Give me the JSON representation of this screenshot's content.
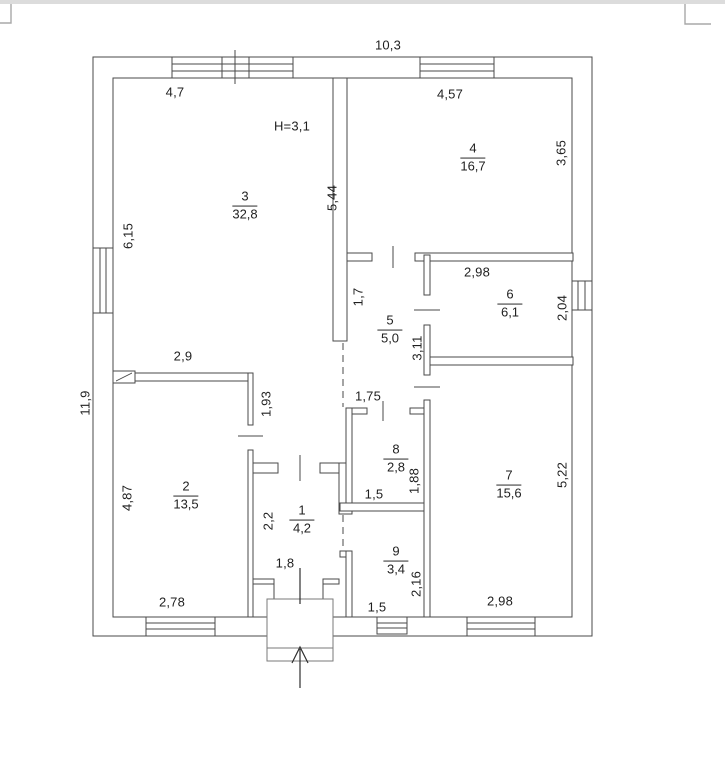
{
  "page": {
    "top_band_color": "#dcdcdc",
    "artifact_color": "#a8a8a8"
  },
  "plan": {
    "line_color": "#4a4a4a",
    "overall_width": "10,3",
    "overall_height": "11,9",
    "ceiling_height": "H=3,1",
    "rooms": [
      {
        "number": "1",
        "area": "4,2"
      },
      {
        "number": "2",
        "area": "13,5"
      },
      {
        "number": "3",
        "area": "32,8"
      },
      {
        "number": "4",
        "area": "16,7"
      },
      {
        "number": "5",
        "area": "5,0"
      },
      {
        "number": "6",
        "area": "6,1"
      },
      {
        "number": "7",
        "area": "15,6"
      },
      {
        "number": "8",
        "area": "2,8"
      },
      {
        "number": "9",
        "area": "3,4"
      }
    ],
    "dimensions": {
      "r3_top": "4,7",
      "r3_left": "6,15",
      "r3_right": "5,44",
      "r4_top": "4,57",
      "r4_right": "3,65",
      "r2_top": "2,9",
      "r2_right_wall": "1,93",
      "r2_left": "4,87",
      "r2_bottom": "2,78",
      "stub": "1,7",
      "corridor": "3,11",
      "hall_top": "1,75",
      "r6_top": "2,98",
      "r6_right": "2,04",
      "r7_right": "5,22",
      "r7_bottom": "2,98",
      "r8_width": "1,5",
      "r8_right": "1,88",
      "r1_left": "2,2",
      "r1_bottom": "1,8",
      "r9_right": "2,16",
      "r9_bottom": "1,5"
    }
  }
}
